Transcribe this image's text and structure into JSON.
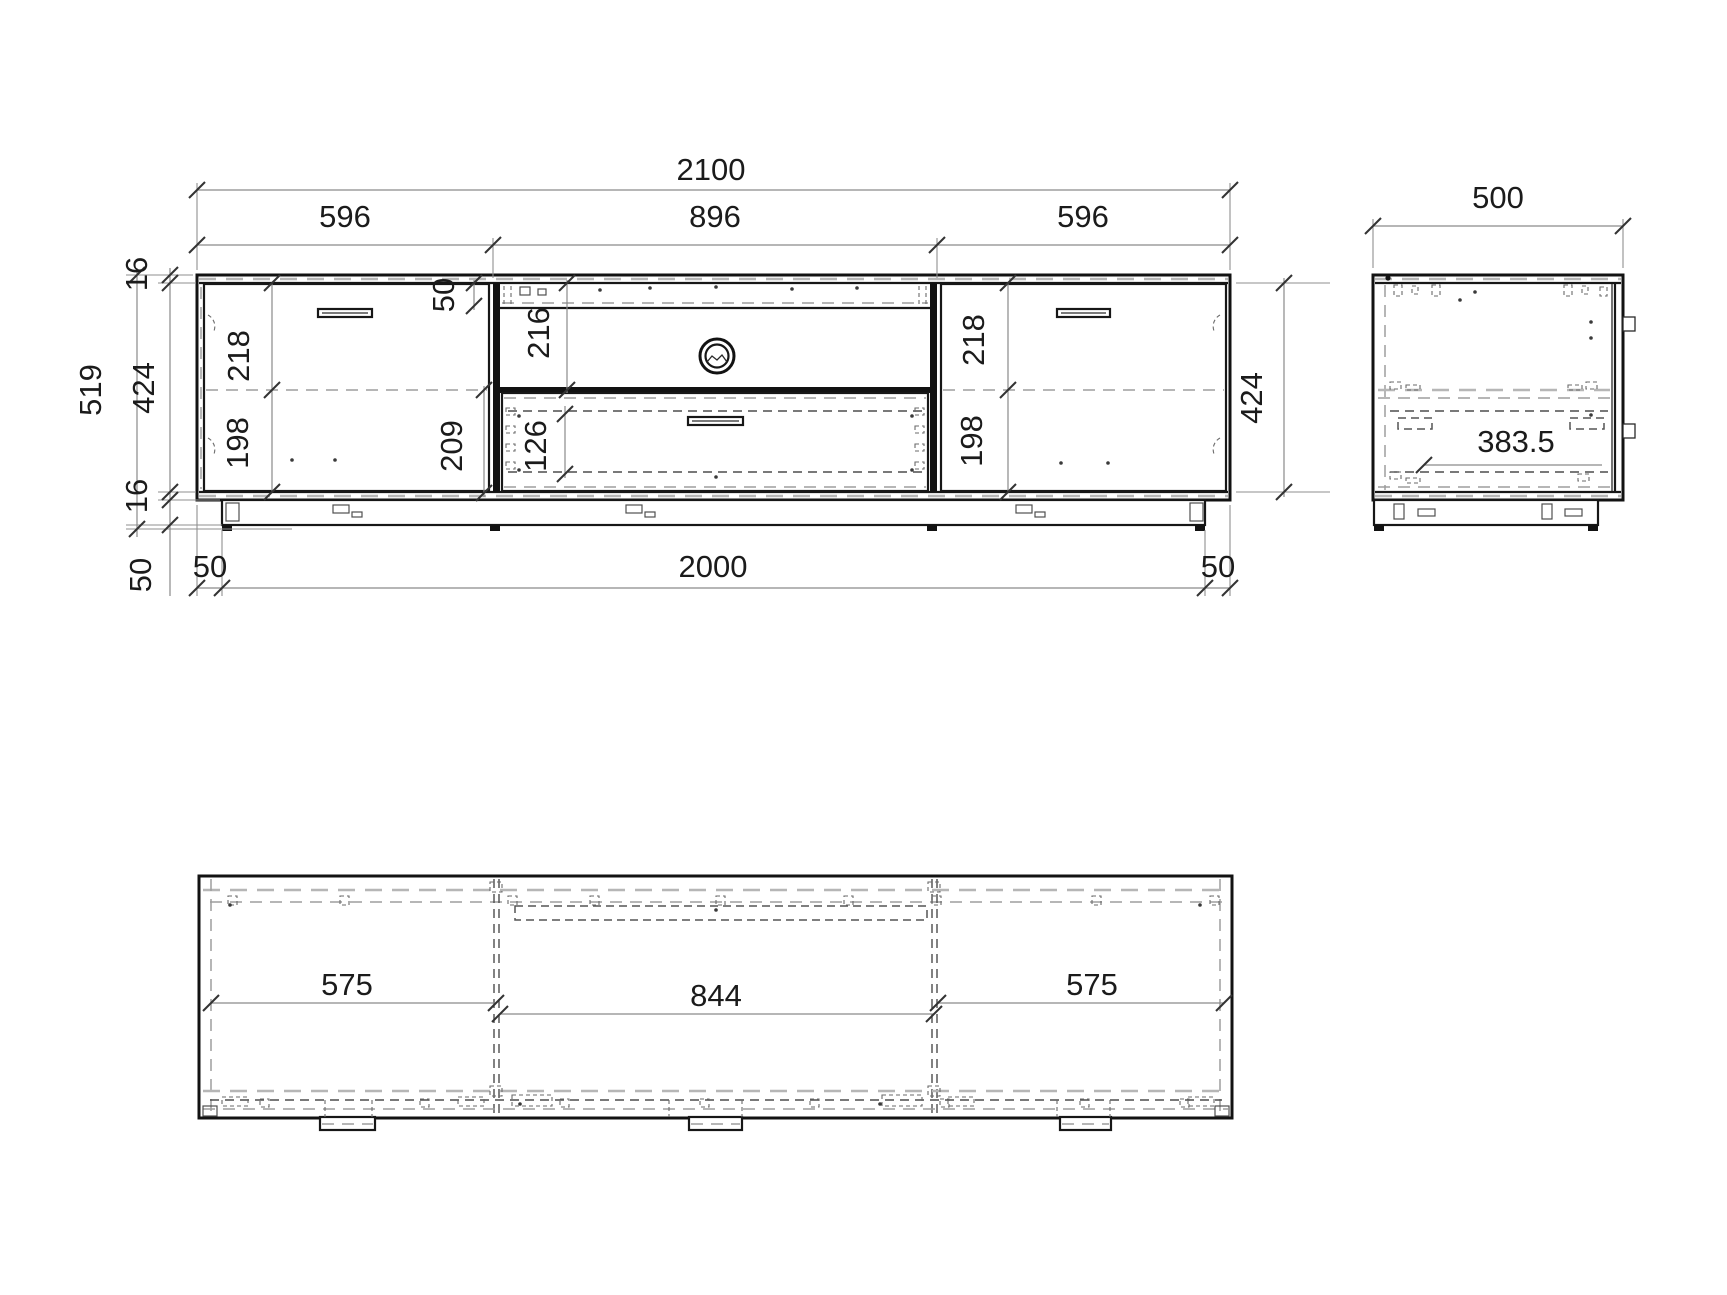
{
  "drawing": {
    "type": "furniture technical drawing",
    "views": {
      "front": "front-elevation",
      "side": "side-section",
      "plan": "top-plan"
    }
  },
  "dimensions": {
    "front": {
      "total_width": "2100",
      "section_left": "596",
      "section_middle": "896",
      "section_right": "596",
      "total_height": "519",
      "panel_top": "16",
      "inner_height": "424",
      "panel_bottom": "16",
      "plinth_height": "50",
      "top_rail": "50",
      "open_compartment": "216",
      "drawer_zone": "209",
      "drawer_box": "126",
      "door_left_upper": "218",
      "door_left_lower": "198",
      "door_right_upper": "218",
      "door_right_lower": "198",
      "carcass_height": "424",
      "plinth_offset_left": "50",
      "plinth_length": "2000",
      "plinth_offset_right": "50"
    },
    "side": {
      "depth": "500",
      "interior_depth": "383.5"
    },
    "plan": {
      "inner_left": "575",
      "inner_middle": "844",
      "inner_right": "575"
    }
  }
}
